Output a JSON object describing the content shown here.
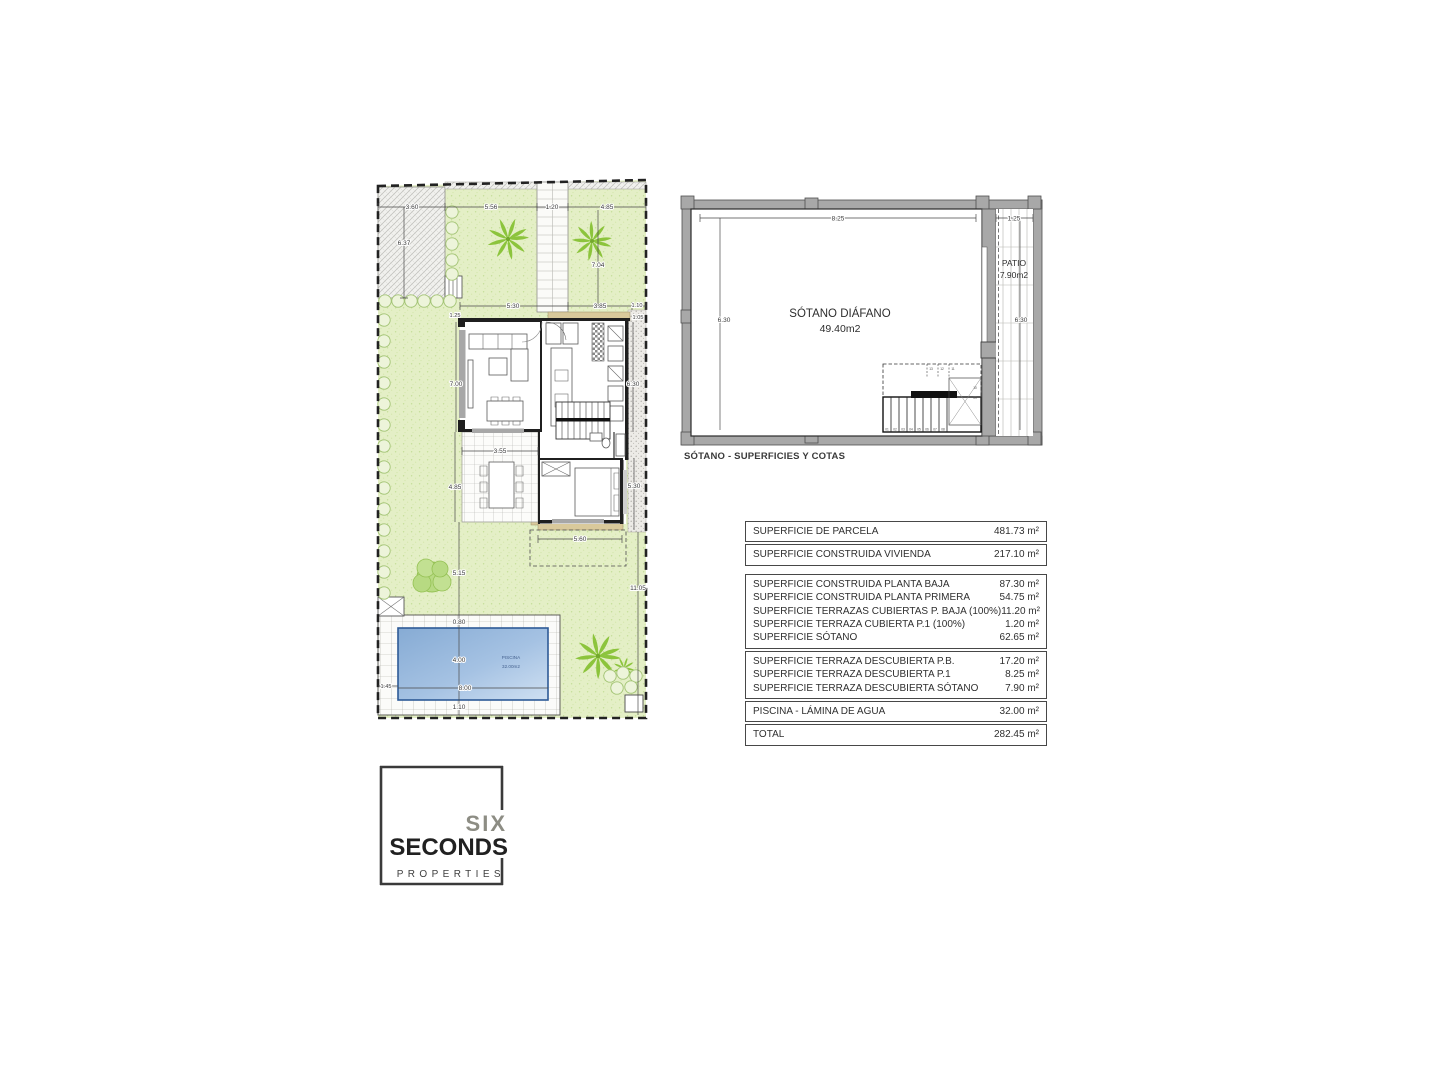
{
  "site": {
    "pool_label": "PISCINA",
    "pool_area": "32.00m2",
    "dims": {
      "top1": "3.60",
      "top2": "5.56",
      "top3": "1.20",
      "top4": "4.85",
      "left1": "6.37",
      "left2": "7.00",
      "left3": "5.15",
      "right_top": "7.04",
      "right1": "6.30",
      "right2": "11.05",
      "mid1": "5.30",
      "mid2": "3.85",
      "mid3": "1.10",
      "mid4": "1.25",
      "mid5": "1.05",
      "terrace_w": "3.55",
      "terrace_h": "4.85",
      "bedroom_r": "5.30",
      "porch_w": "5.60",
      "pool_top": "0.80",
      "pool_h": "4.00",
      "pool_w": "8.00",
      "pool_left": "1.45",
      "pool_bottom": "1.10"
    }
  },
  "basement": {
    "room_label": "SÓTANO DIÁFANO",
    "room_area": "49.40m2",
    "patio_label": "PATIO",
    "patio_area": "7.90m2",
    "dims": {
      "width": "8.25",
      "height": "6.30",
      "patio_width": "1.25",
      "patio_height": "6.30"
    },
    "stairs": {
      "bottom": [
        "01",
        "02",
        "03",
        "04",
        "05",
        "06",
        "07",
        "08"
      ],
      "right": [
        "10",
        "09"
      ],
      "top": [
        "13",
        "12",
        "11"
      ]
    },
    "caption": "SÓTANO - SUPERFICIES Y COTAS"
  },
  "areas_table": {
    "groups": [
      {
        "rows": [
          {
            "label": "SUPERFICIE DE PARCELA",
            "value": "481.73 m²"
          }
        ]
      },
      {
        "rows": [
          {
            "label": "SUPERFICIE CONSTRUIDA VIVIENDA",
            "value": "217.10 m²"
          }
        ]
      },
      {
        "rows": [
          {
            "label": "SUPERFICIE CONSTRUIDA PLANTA BAJA",
            "value": "87.30 m²"
          },
          {
            "label": "SUPERFICIE CONSTRUIDA PLANTA PRIMERA",
            "value": "54.75 m²"
          },
          {
            "label": "SUPERFICIE TERRAZAS CUBIERTAS P. BAJA (100%)",
            "value": "11.20 m²"
          },
          {
            "label": "SUPERFICIE TERRAZA CUBIERTA P.1 (100%)",
            "value": "1.20 m²"
          },
          {
            "label": "SUPERFICIE SÓTANO",
            "value": "62.65 m²"
          }
        ]
      },
      {
        "rows": [
          {
            "label": "SUPERFICIE TERRAZA DESCUBIERTA P.B.",
            "value": "17.20 m²"
          },
          {
            "label": "SUPERFICIE TERRAZA DESCUBIERTA P.1",
            "value": "8.25 m²"
          },
          {
            "label": "SUPERFICIE TERRAZA DESCUBIERTA SÓTANO",
            "value": "7.90 m²"
          }
        ]
      },
      {
        "rows": [
          {
            "label": "PISCINA - LÁMINA DE AGUA",
            "value": "32.00 m²"
          }
        ]
      },
      {
        "rows": [
          {
            "label": "TOTAL",
            "value": "282.45 m²"
          }
        ]
      }
    ]
  },
  "logo": {
    "word_top": "SIX",
    "word_main": "SECONDS",
    "word_sub": "PROPERTIES"
  },
  "colors": {
    "lawn": "#e4efc6",
    "palm": "#8cc43c",
    "pool_dark": "#86abd4",
    "pool_light": "#cfe0f2",
    "tan": "#d9c99b",
    "wall_grey": "#a8a8a8"
  }
}
